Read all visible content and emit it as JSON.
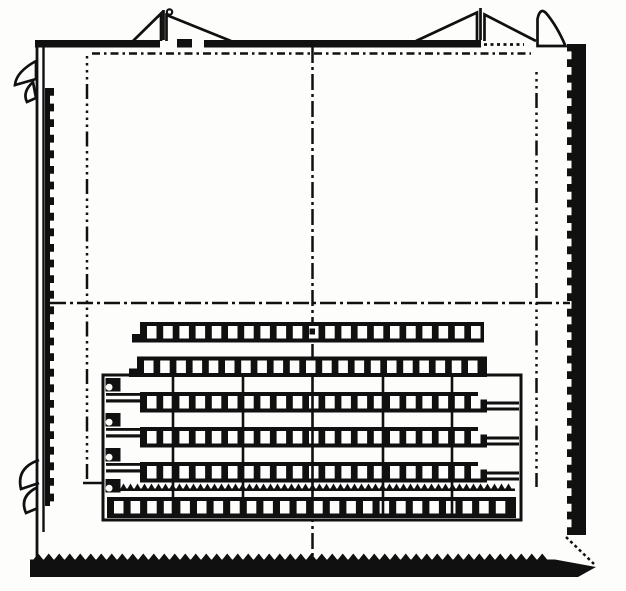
{
  "figure": {
    "title": "patent-style technical line drawing",
    "description": "Square container frame with dash-dot centerlines, corner clamp triangles, hatched side walls and a stack of six perforated strips inside a divided tray",
    "background": "#fdfdfc",
    "ink": "#101010",
    "white": "#fdfdfc"
  },
  "canvas": {
    "width": 626,
    "height": 591
  },
  "guides": [
    {
      "name": "top-dashdot-guide",
      "x1": 92,
      "y1": 53.5,
      "x2": 531,
      "y2": 53.5,
      "w": 2.5,
      "dash": "8 4 2.5 4"
    },
    {
      "name": "vertical-centerline",
      "x1": 312.5,
      "y1": 47,
      "x2": 312.5,
      "y2": 556,
      "w": 2.5,
      "dash": "16 4 3 4"
    },
    {
      "name": "horizontal-centerline",
      "x1": 50,
      "y1": 303,
      "x2": 570,
      "y2": 303,
      "w": 2.5,
      "dash": "16 4 3 4"
    },
    {
      "name": "left-dotted-guideline",
      "x1": 87,
      "y1": 56,
      "x2": 87,
      "y2": 483,
      "w": 2.5,
      "dash": "2.5 4.5 2.5 4.5 2.5 4.5 2.5 4.5 15 4.5"
    },
    {
      "name": "right-dotted-guideline",
      "x1": 536.5,
      "y1": 72,
      "x2": 536.5,
      "y2": 487,
      "w": 2.5,
      "dash": "2.5 4.5 2.5 4.5 2.5 4.5 15 4.5 2.5 4.5"
    },
    {
      "name": "top-right-dotted-gap",
      "x1": 484,
      "y1": 44.5,
      "x2": 524,
      "y2": 44.5,
      "w": 2.8,
      "dash": "3 3.5"
    },
    {
      "name": "corner-chamfer-dots",
      "x1": 566,
      "y1": 537,
      "x2": 594,
      "y2": 564,
      "w": 2.5,
      "dash": "3 3"
    },
    {
      "name": "tray-left-tick",
      "x1": 83,
      "y1": 483,
      "x2": 104,
      "y2": 483,
      "w": 2.5,
      "dash": ""
    }
  ],
  "frame": {
    "top_bar_segments": [
      {
        "name": "top-border-left",
        "x": 35,
        "y": 40,
        "w": 125,
        "h": 7.5
      },
      {
        "name": "top-border-right",
        "x": 204,
        "y": 40,
        "w": 277,
        "h": 7.5
      }
    ],
    "top_bar_block": {
      "name": "top-border-block",
      "x": 177,
      "y": 39,
      "w": 15,
      "h": 8.5
    },
    "left_outer_line": {
      "name": "left-border-outer-line",
      "x1": 37,
      "y1": 40,
      "x2": 37,
      "y2": 559,
      "w": 2.8
    },
    "left_inner_line": {
      "name": "left-border-inner-line",
      "x1": 43.5,
      "y1": 46,
      "x2": 43.5,
      "y2": 532,
      "w": 2.4
    },
    "left_jagged_bar": {
      "name": "left-hatched-wall",
      "x": 45,
      "w": 9,
      "y1": 88,
      "y2": 506,
      "pitch": 7.8,
      "amp": 4,
      "edge": "right"
    },
    "right_jagged_bar": {
      "name": "right-hatched-wall",
      "x": 567,
      "w": 19,
      "y1": 44,
      "y2": 535,
      "pitch": 7.8,
      "amp": 4.5,
      "edge": "left"
    },
    "bottom_bar": {
      "name": "bottom-border",
      "points": "30,577 30,559.5 555,559.5 596,567 578,577",
      "teeth": {
        "x1": 33,
        "x2": 551,
        "y": 560,
        "pitch": 10.5,
        "h": 6.5
      }
    }
  },
  "ornaments": [
    {
      "name": "left-top-pennant",
      "type": "path",
      "d": "M36,61 Q16,72 15,85 L36,79 Z",
      "fill": "#fdfdfc"
    },
    {
      "name": "left-top-pennant-tail",
      "type": "path",
      "d": "M33,82 Q22,92 27,102 L36,98 Z",
      "fill": "#fdfdfc"
    },
    {
      "name": "left-bottom-hook-upper",
      "type": "path",
      "d": "M39,460 Q16,468 21,489 L39,483",
      "fill": "#fdfdfc"
    },
    {
      "name": "left-bottom-hook-lower",
      "type": "path",
      "d": "M36,488 Q19,497 26,513 L38,508",
      "fill": "#fdfdfc"
    },
    {
      "name": "left-clamp-triangle-a",
      "type": "path",
      "d": "M133,41 L161,13.5 L161,41",
      "fill": "#fdfdfc"
    },
    {
      "name": "left-clamp-stem",
      "type": "line",
      "x1": 163.5,
      "y1": 10,
      "x2": 163.5,
      "y2": 40,
      "w": 2.7
    },
    {
      "name": "left-clamp-pin",
      "type": "circle",
      "cx": 169.5,
      "cy": 12,
      "r": 2.7,
      "fill": "#fdfdfc"
    },
    {
      "name": "left-clamp-triangle-b",
      "type": "path",
      "d": "M231,41 L166.5,15 L166.5,41",
      "fill": "#fdfdfc"
    },
    {
      "name": "right-clamp-triangle-a",
      "type": "path",
      "d": "M416,41 L477,12.5 L477,41",
      "fill": "#fdfdfc"
    },
    {
      "name": "right-clamp-stem",
      "type": "line",
      "x1": 480.5,
      "y1": 8,
      "x2": 480.5,
      "y2": 40,
      "w": 2.7
    },
    {
      "name": "right-clamp-triangle-b",
      "type": "path",
      "d": "M536,41 L484.5,14.5 L484.5,41",
      "fill": "#fdfdfc"
    },
    {
      "name": "right-top-flap",
      "type": "path",
      "d": "M537.5,46 L537.5,19 Q540,7 546,13 Q557,26 565.5,46 Z",
      "fill": "#fdfdfc"
    }
  ],
  "tray": {
    "outline": {
      "name": "tray-outline",
      "x": 103,
      "y": 375,
      "w": 418,
      "h": 145,
      "stroke": 3
    },
    "dividers": {
      "name": "tray-divider",
      "xs": [
        173,
        243,
        312.5,
        383,
        452
      ],
      "y1": 377,
      "y2": 518,
      "w": 2.6
    },
    "hooks": {
      "name": "tray-latch-hook",
      "x": 105.5,
      "w": 15,
      "h": 13.5,
      "ys": [
        378,
        413,
        448,
        479
      ]
    },
    "tails": {
      "name": "strip-left-tail",
      "x": 106,
      "w": 37,
      "h": 9.5,
      "slot_h": 3.5,
      "ys": [
        393,
        428,
        463
      ]
    },
    "forks": {
      "name": "strip-right-fork",
      "x": 486,
      "w": 33,
      "h": 3,
      "gap": 6,
      "ys": [
        401.5,
        436.5,
        471.5
      ]
    },
    "teeth_band": {
      "name": "tray-sawtooth-band",
      "x1": 113,
      "x2": 515,
      "base_y": 489.5,
      "base_h": 2.5,
      "pitch": 7,
      "h": 6
    }
  },
  "strips": {
    "hole": {
      "w": 9.5,
      "h": 12.5,
      "dx": 7,
      "dy": 4,
      "pitch": 16.2
    },
    "rows": [
      {
        "name": "strip-row-1",
        "x": 140,
        "y": 322,
        "w": 344,
        "h": 20.5,
        "holes": 21,
        "left_step": true
      },
      {
        "name": "strip-row-2",
        "x": 137,
        "y": 356.5,
        "w": 350,
        "h": 20.5,
        "holes": 21,
        "left_step": true
      },
      {
        "name": "strip-row-3",
        "x": 140,
        "y": 392,
        "w": 347,
        "h": 20.5,
        "holes": 21,
        "notch": true
      },
      {
        "name": "strip-row-4",
        "x": 140,
        "y": 427,
        "w": 347,
        "h": 20.5,
        "holes": 21,
        "notch": true
      },
      {
        "name": "strip-row-5",
        "x": 140,
        "y": 462,
        "w": 347,
        "h": 20.5,
        "holes": 21,
        "notch": true
      },
      {
        "name": "strip-row-6",
        "x": 107,
        "y": 497,
        "w": 409,
        "h": 21,
        "holes": 24,
        "pitch": 16.6
      }
    ],
    "center_dot": {
      "name": "center-pivot-dot",
      "x": 309.5,
      "y": 328.5,
      "w": 5.5,
      "h": 6
    }
  }
}
